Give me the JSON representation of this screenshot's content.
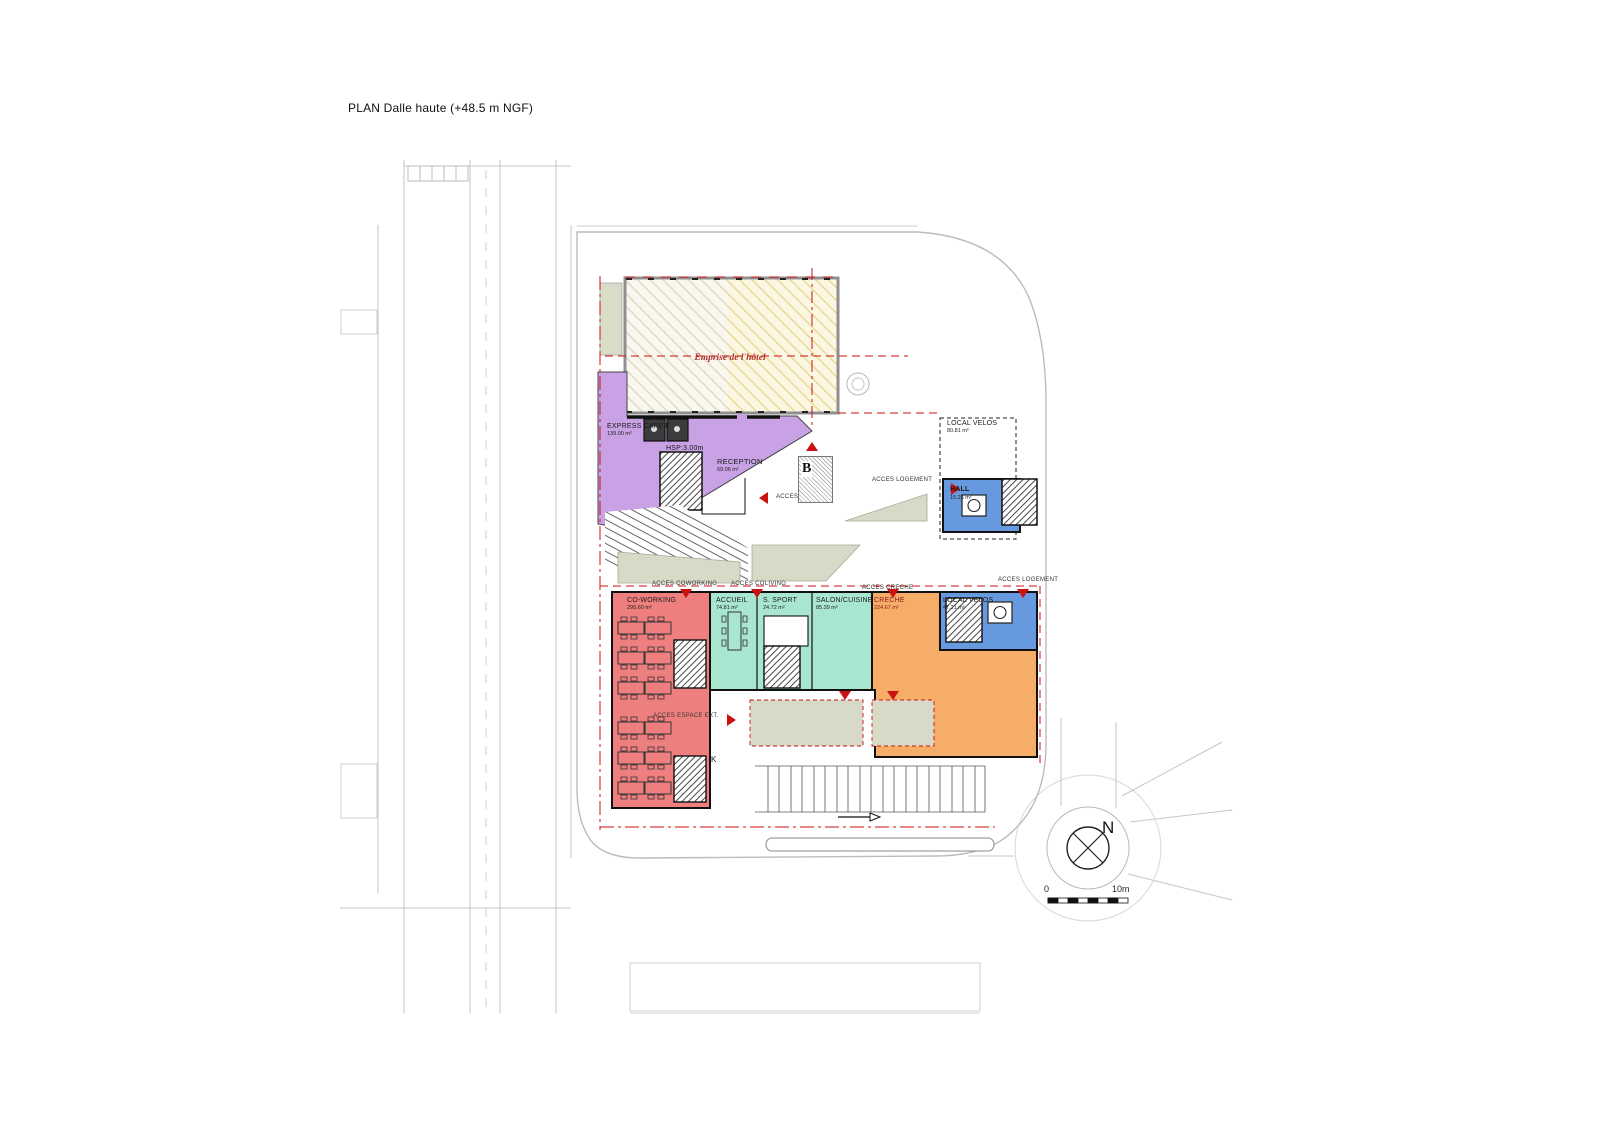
{
  "title": "PLAN Dalle haute (+48.5 m NGF)",
  "hotel": {
    "label": "Emprise de l'hôtel"
  },
  "rooms": {
    "express_cafe": {
      "name": "EXPRESS CAFE E",
      "area": "139.00 m²"
    },
    "hsp_note": "HSP:3.00m",
    "reception": {
      "name": "RECEPTION",
      "area": "69.06 m²"
    },
    "local_velos_upper": {
      "name": "LOCAL VELOS",
      "area": "80.81 m²"
    },
    "hall": {
      "name": "HALL",
      "area": "15.25 m²"
    },
    "coworking": {
      "name": "CO-WORKING",
      "area": "295.60 m²"
    },
    "accueil": {
      "name": "ACCUEIL",
      "area": "74.81 m²"
    },
    "sport": {
      "name": "S. SPORT",
      "area": "24.72 m²"
    },
    "salon_cuisine": {
      "name": "SALON/CUISINE",
      "area": "85.39 m²"
    },
    "creche": {
      "name": "CRECHE",
      "area": "224.67 m²"
    },
    "local_velos_lower": {
      "name": "LOCAL VELOS",
      "area": "47.21 m²"
    }
  },
  "access": {
    "hotel": "ACCES HOTEL",
    "logement_upper": "ACCES LOGEMENT",
    "coworking": "ACCES COWORKING",
    "coliving": "ACCES COLIVING",
    "creche": "ACCES CRECHE",
    "logement_lower": "ACCES LOGEMENT",
    "espace_ext": "ACCES ESPACE EXT."
  },
  "annotations": {
    "k": "K",
    "stamp": "B"
  },
  "compass": {
    "north": "N"
  },
  "scale_bar": {
    "start": "0",
    "end": "10m"
  },
  "colors": {
    "hotel_zone": "#c9a2e6",
    "coworking_zone": "#ef7f7f",
    "coliving_zone": "#a8e6d0",
    "creche_zone": "#f6ad68",
    "circulation_zone": "#6699dd",
    "landscape": "#d6dac6",
    "boundary_red": "#cc1111"
  }
}
